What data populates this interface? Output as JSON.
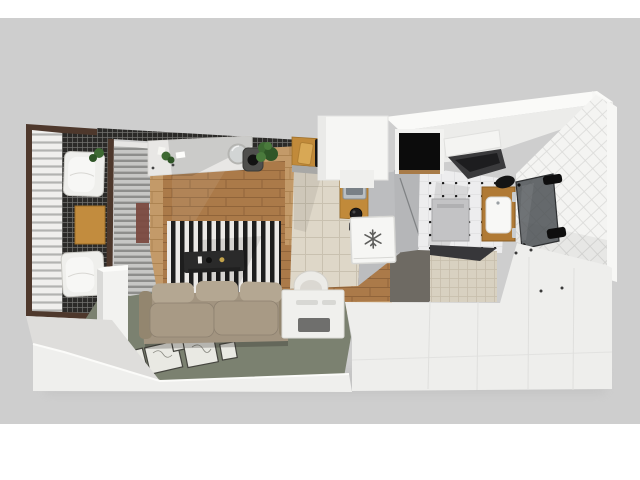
{
  "canvas": {
    "width": 640,
    "height": 480,
    "letterbox": "#ffffff",
    "background": "#cecece"
  },
  "objects": [
    "balcony",
    "balcony-glazing-shutters",
    "balcony-deck",
    "lounge-chair",
    "balcony-coffee-table",
    "roller-blinds",
    "radiator-panel",
    "console-desk",
    "round-mirror",
    "houseplant",
    "wood-plank-floor",
    "wood-accent-wall",
    "striped-tv-wall",
    "tv-console",
    "sofa",
    "picture-frames-on-floor",
    "green-floor",
    "side-cabinet",
    "shell-chair",
    "kitchen-counter",
    "cooktop",
    "cutting-board",
    "kitchen-sink",
    "kettle",
    "fridge",
    "wardrobe-niche",
    "bathroom-floor",
    "washing-machine",
    "vanity",
    "wash-basin",
    "shower-glass",
    "tiled-wall",
    "backsplash",
    "entrance-wall-block",
    "front-wall-panel"
  ],
  "scene": {
    "balcony": {
      "frame": "#4e382c",
      "glazing_light": "#f0efed",
      "glazing_dark": "#b3b3b1",
      "deck": "#2b2a28",
      "deck_mesh": "#72726f",
      "lounger": "#efefec",
      "lounger_inner": "#f7f7f5",
      "lounger_edge": "#c9c8c3",
      "table_wood": "#c28c3e"
    },
    "blinds": {
      "light": "#c7c7c5",
      "dark": "#8e8e8c",
      "radiator": "#7b4a40"
    },
    "walls": {
      "cut_top": "#fafaf8",
      "face": "#ececea",
      "sliver": "#e7e6e4",
      "slab": "#efefed",
      "under_balcony": "#dedddb",
      "column": "#f2f2f0",
      "column_side": "#d9d9d7",
      "block": "#f6f6f4"
    },
    "wood": {
      "floor": "#c39a69",
      "floor_line": "#9a733f",
      "wall": "#ab7a49",
      "wall_line": "#7e5530"
    },
    "accent_wall": {
      "stripe_dark": "#1e1e1e",
      "stripe_light": "#eceae7",
      "tv_console": "#2a2a2a",
      "vase_gold": "#c2a24a"
    },
    "sofa": {
      "base": "#a29480",
      "cushion": "#b4a792",
      "seat": "#a89a85",
      "arm": "#93866f"
    },
    "floor_green": {
      "base": "#7b8170",
      "shade": "#6e7463"
    },
    "frames": {
      "fill": "#e9e9e3",
      "stroke": "#45453f",
      "sketch": "#8a8a82"
    },
    "desk": {
      "top": "#e8e7e5",
      "stool": "#4f4f4d",
      "kettle": "#121212",
      "mirror": "#d2d5d5",
      "mirror_rim": "#b5b5b2"
    },
    "plants": {
      "dark": "#2f5527",
      "mid": "#3e6a33",
      "light": "#4a7a3c"
    },
    "kitchen": {
      "tile": "#ded7c8",
      "tile_line": "#c9c1b0",
      "counter": "#c18a3a",
      "counter_edge": "#9c6e2a",
      "counter_front": "#a8a8a6",
      "board": "#d8a855",
      "cooktop": "#141414",
      "burner": "#3f3f3d",
      "sink": "#b9bec2",
      "sink_inner": "#798086",
      "appliance": "#1c1c1e",
      "slippers": "#b04f2c"
    },
    "fridge": {
      "body": "#f6f6f4",
      "edge": "#d8d8d5",
      "snowflake": "#5e5e5c"
    },
    "hall": {
      "floor": "#bcbdbf"
    },
    "bathroom": {
      "floor": "#ededee",
      "dot": "#1c1c1c",
      "gray_zone": "#b5b6b8",
      "niche": "#0c0c0c",
      "niche_frame": "#f2f2f0",
      "cabinet": "#f4f4f2",
      "hood": "#3a3a3c",
      "vanity": "#b07a35",
      "basin": "#f8f8f6",
      "towel": "#141414",
      "glass": "rgba(70,74,78,0.82)",
      "glass_frame": "#2e3032",
      "roller": "#0e0e0e",
      "machine": "#c3c3c5"
    },
    "tiles": {
      "wall": "#f4f4f2",
      "line": "#dcdcda",
      "outer_edge": "#f7f7f5"
    },
    "backsplash": {
      "tile": "#d8d1c1",
      "line": "#c6bdab",
      "hood": "#37373a",
      "gap": "#6e6a63"
    },
    "front_face": {
      "fill": "#eeeeec",
      "seam": "#dfdfdd",
      "dot": "#3a3a3a"
    }
  }
}
